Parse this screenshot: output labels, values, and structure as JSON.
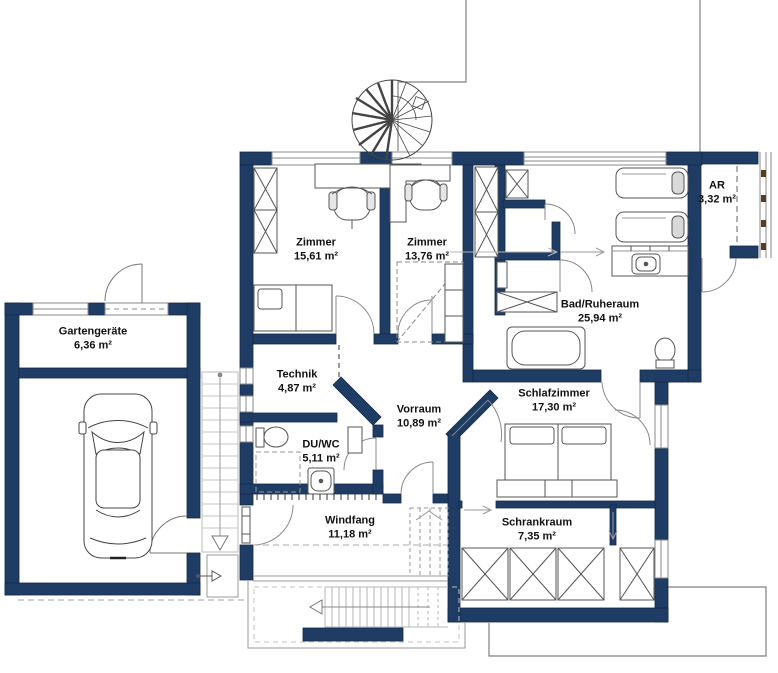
{
  "drawing": {
    "type": "floor-plan",
    "colors": {
      "wall": "#1e3c64",
      "wall_edge": "#13294a",
      "thin_line": "#808080",
      "furniture_line": "#555555",
      "dashed_line": "#a0a0a0",
      "text": "#111111"
    },
    "rooms": [
      {
        "id": "zimmer-1",
        "name": "Zimmer",
        "area": "15,61 m²"
      },
      {
        "id": "zimmer-2",
        "name": "Zimmer",
        "area": "13,76 m²"
      },
      {
        "id": "bad-ruheraum",
        "name": "Bad/Ruheraum",
        "area": "25,94 m²"
      },
      {
        "id": "ar",
        "name": "AR",
        "area": "3,32 m²"
      },
      {
        "id": "technik",
        "name": "Technik",
        "area": "4,87 m²"
      },
      {
        "id": "vorraum",
        "name": "Vorraum",
        "area": "10,89 m²"
      },
      {
        "id": "du-wc",
        "name": "DU/WC",
        "area": "5,11 m²"
      },
      {
        "id": "schlafzimmer",
        "name": "Schlafzimmer",
        "area": "17,30 m²"
      },
      {
        "id": "schrankraum",
        "name": "Schrankraum",
        "area": "7,35 m²"
      },
      {
        "id": "windfang",
        "name": "Windfang",
        "area": "11,18 m²"
      },
      {
        "id": "gartengeraete",
        "name": "Gartengeräte",
        "area": "6,36 m²"
      }
    ]
  }
}
